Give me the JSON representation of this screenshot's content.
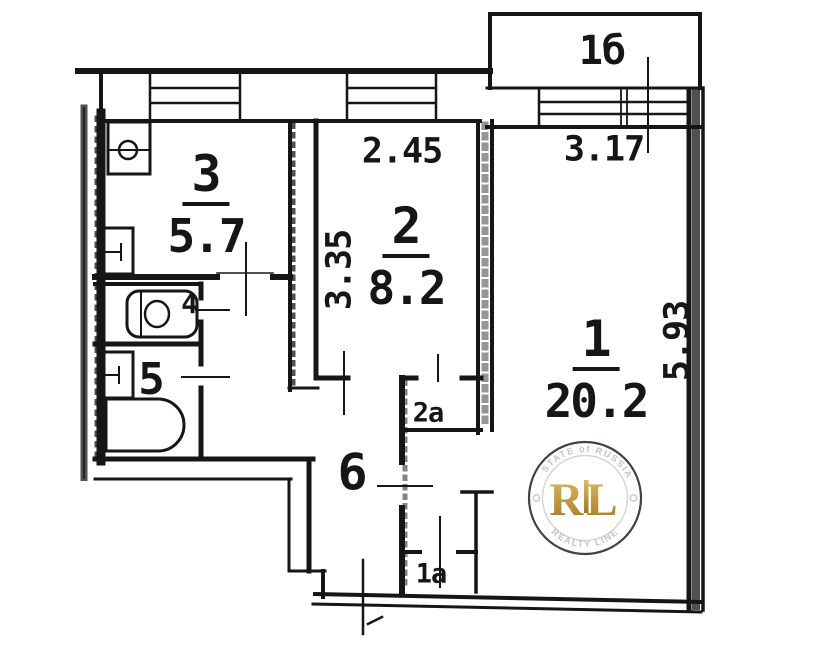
{
  "rooms": {
    "room1": {
      "number": "1",
      "area": "20.2"
    },
    "room2": {
      "number": "2",
      "area": "8.2"
    },
    "kitchen": {
      "number": "3",
      "area": "5.7"
    },
    "wc": {
      "number": "4"
    },
    "bath": {
      "number": "5"
    },
    "hall": {
      "number": "6"
    },
    "balcony": {
      "number": "1б"
    },
    "closet_2a": {
      "number": "2а"
    },
    "closet_1a": {
      "number": "1а"
    }
  },
  "dimensions": {
    "room2_width": "2.45",
    "room2_depth": "3.35",
    "room1_width": "3.17",
    "room1_depth": "5.93"
  },
  "watermark": {
    "arc_top": "ESTATE of RUSSIA",
    "arc_bottom": "REALTY LINE",
    "monogram": "RL"
  },
  "colors": {
    "line": "#161616",
    "watermark_gold": "#b98f35",
    "watermark_text": "#c7c3bb"
  }
}
